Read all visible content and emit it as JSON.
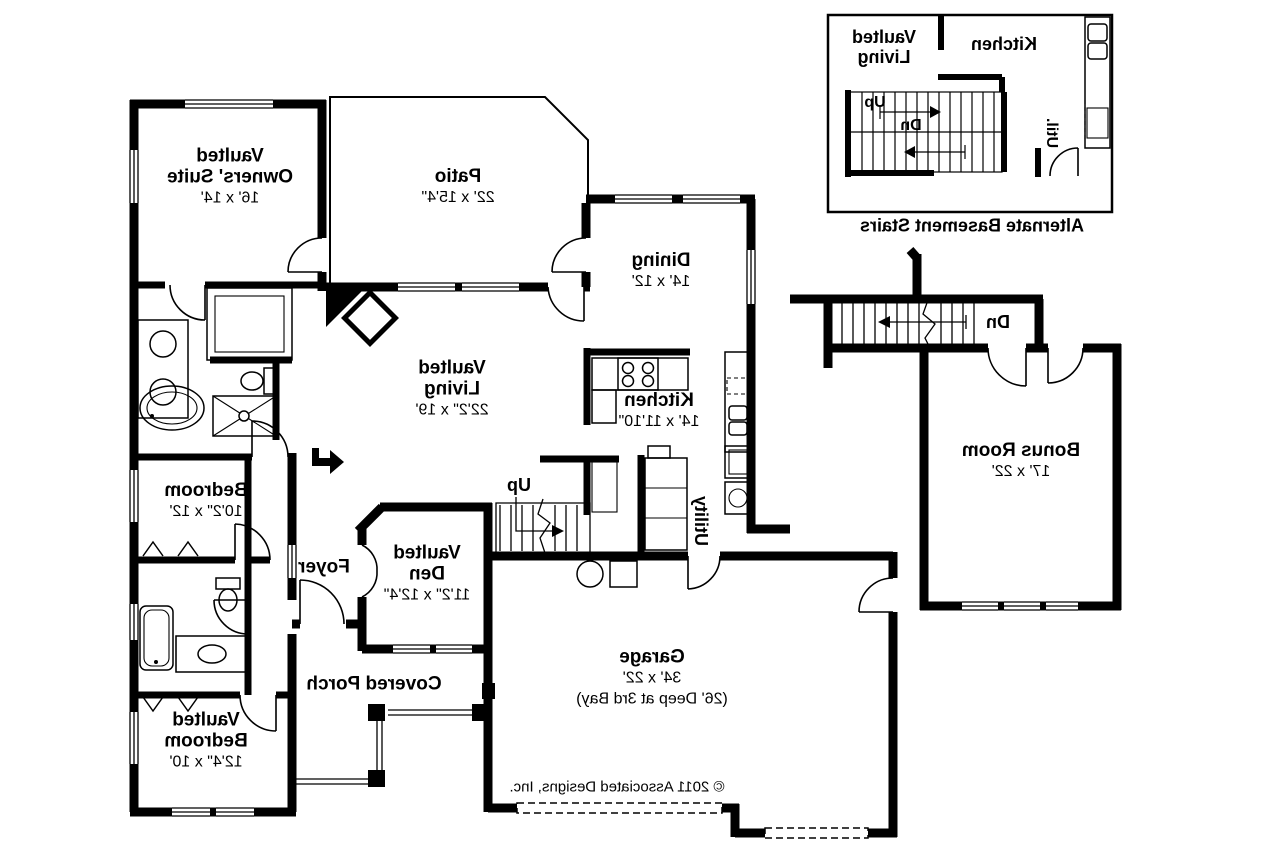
{
  "colors": {
    "ink": "#000000",
    "background": "#ffffff"
  },
  "rooms": {
    "owners_suite": {
      "lines": [
        "Vaulted",
        "Owners' Suite",
        "16' x 14'"
      ]
    },
    "patio": {
      "name": "Patio",
      "dims": "22' x 15'4\""
    },
    "dining": {
      "name": "Dining",
      "dims": "14' x 12'"
    },
    "living": {
      "lines": [
        "Vaulted",
        "Living",
        "22'2\" x 19'"
      ]
    },
    "kitchen": {
      "name": "Kitchen",
      "dims": "14' x 11'10\""
    },
    "utility": {
      "name": "Utility"
    },
    "bedroom1": {
      "name": "Bedroom",
      "dims": "10'2\" x 12'"
    },
    "foyer": {
      "name": "Foyer"
    },
    "den": {
      "lines": [
        "Vaulted",
        "Den",
        "11'2\" x 12'4\""
      ]
    },
    "covered_porch": {
      "name": "Covered Porch"
    },
    "bedroom2": {
      "lines": [
        "Vaulted",
        "Bedroom",
        "12'4\" x 10'"
      ]
    },
    "garage": {
      "name": "Garage",
      "dims": "34' x 22'",
      "note": "(26' Deep at 3rd Bay)"
    },
    "bonus_room": {
      "name": "Bonus Room",
      "dims": "17' x 22'"
    }
  },
  "stairs": {
    "up": "Up",
    "dn": "Dn"
  },
  "inset": {
    "living_lines": [
      "Vaulted",
      "Living"
    ],
    "kitchen": "Kitchen",
    "up": "Up",
    "dn": "Dn",
    "util": "Util.",
    "caption": "Alternate Basement Stairs"
  },
  "copyright": "© 2011 Associated Designs, Inc."
}
